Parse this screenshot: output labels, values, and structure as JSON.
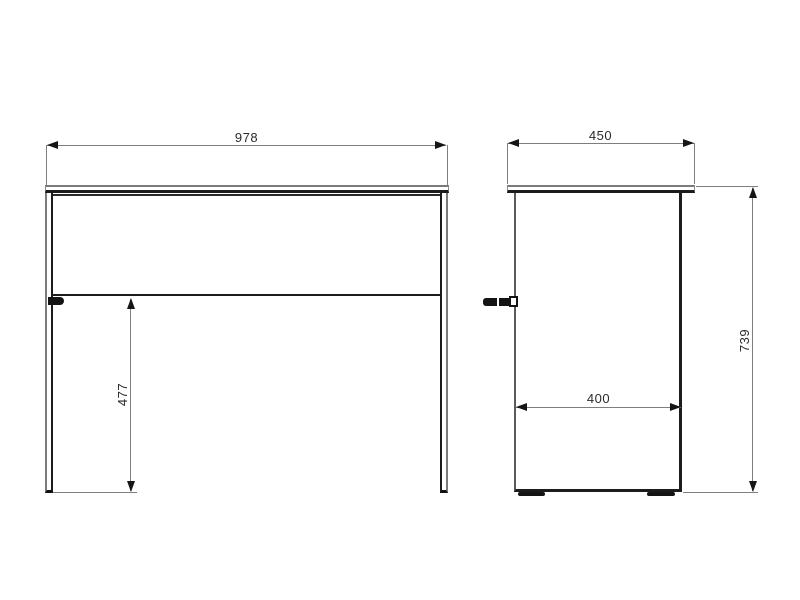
{
  "drawing": {
    "type": "furniture-orthographic-dimension-drawing",
    "views": {
      "front": {
        "name": "front view",
        "width_dim": "978",
        "leg_height_dim": "477"
      },
      "side": {
        "name": "side view",
        "depth_dim": "450",
        "inner_depth_dim": "400",
        "height_dim": "739"
      }
    },
    "colors": {
      "background": "#ffffff",
      "line_dark": "#1c1c1c",
      "line_gray": "#7e7e7e",
      "text": "#2b2b2b"
    }
  }
}
